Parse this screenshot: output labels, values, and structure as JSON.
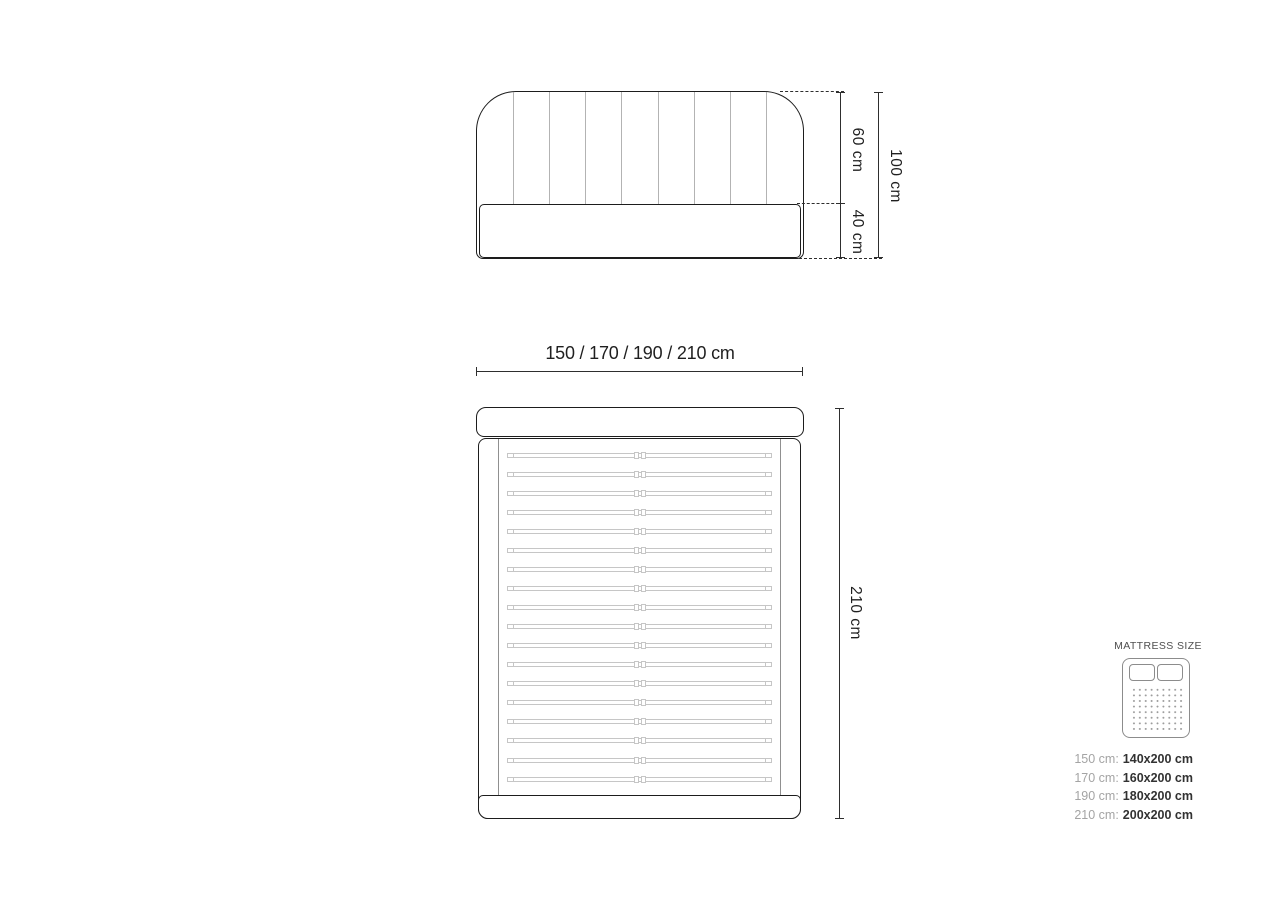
{
  "colors": {
    "outline_dark": "#1d1d1d",
    "channel_gray": "#b3b3b3",
    "slat_gray": "#c6c6c6",
    "rail_gray": "#909090",
    "dimension_line": "#2e2e2e",
    "label_text": "#1f1f1f",
    "icon_gray": "#8c8c8c",
    "dot_gray": "#9c9c9c",
    "size_prefix_gray": "#a4a4a4",
    "size_value_dark": "#323232"
  },
  "front_view": {
    "upper_height_label": "60 cm",
    "lower_height_label": "40 cm",
    "total_height_label": "100 cm",
    "channel_count": 8
  },
  "width_dimension_label": "150 / 170 / 190 / 210 cm",
  "top_view": {
    "length_label": "210 cm",
    "slat_count": 18
  },
  "mattress_panel": {
    "title": "MATTRESS SIZE",
    "icon": "mattress-icon",
    "sizes": [
      {
        "frame_width": "150 cm:",
        "mattress_size": "140x200 cm"
      },
      {
        "frame_width": "170 cm:",
        "mattress_size": "160x200 cm"
      },
      {
        "frame_width": "190 cm:",
        "mattress_size": "180x200 cm"
      },
      {
        "frame_width": "210 cm:",
        "mattress_size": "200x200 cm"
      }
    ]
  }
}
